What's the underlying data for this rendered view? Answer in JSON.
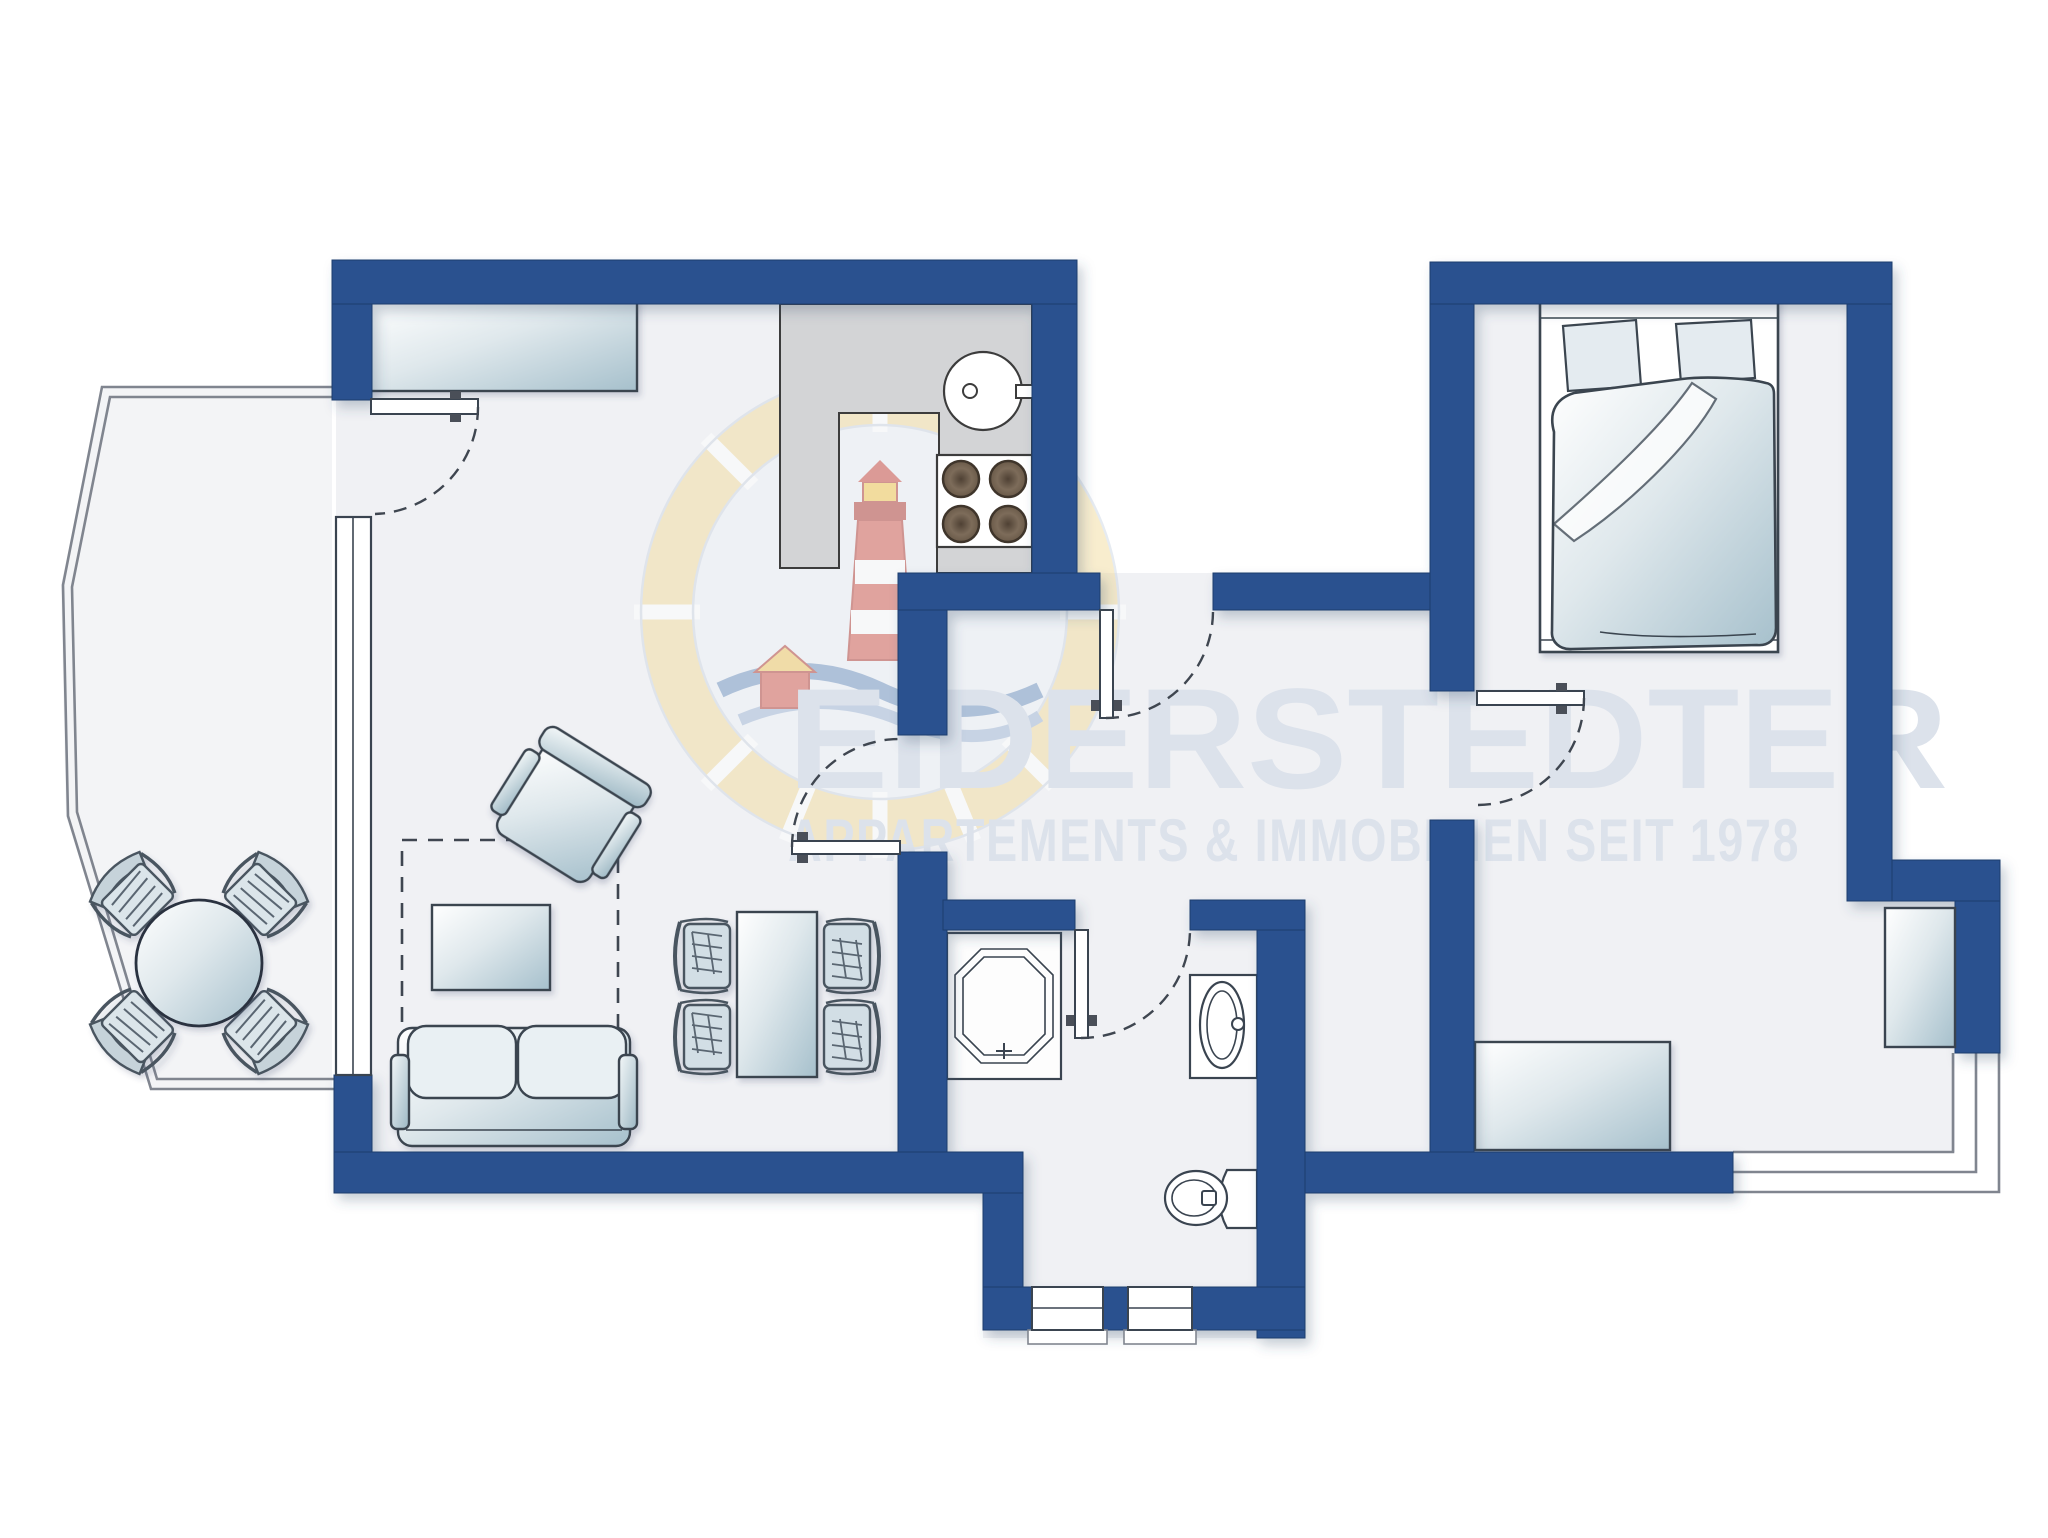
{
  "watermark": {
    "title": "EIDERSTEDTER",
    "subtitle": "APPARTEMENTS & IMMOBILIEN SEIT 1978",
    "logo": "lighthouse-badge-icon"
  },
  "colors": {
    "wall": "#2a518f",
    "floor": "#f0f1f4",
    "balcony": "#f3f4f6",
    "outline": "#3a4450",
    "counter": "#d3d4d6",
    "watermark": "#dce2eb",
    "railing": "#80858f",
    "dash": "#3f4650"
  },
  "plan": {
    "type": "apartment-floor-plan",
    "rooms": [
      {
        "name": "living-room-with-open-kitchen",
        "furniture": [
          "sideboard",
          "armchair",
          "rug",
          "coffee-table",
          "sofa",
          "dining-table",
          "dining-chairs",
          "kitchen-counter",
          "kitchen-sink",
          "stove-4-burners"
        ]
      },
      {
        "name": "hallway",
        "features": [
          "entry-door",
          "living-room-door"
        ]
      },
      {
        "name": "shower-room",
        "furniture": [
          "shower",
          "washbasin",
          "toilet"
        ],
        "features": [
          "two-small-windows"
        ]
      },
      {
        "name": "bedroom",
        "furniture": [
          "double-bed",
          "two-pillows",
          "duvet",
          "dresser"
        ],
        "features": [
          "bedroom-door",
          "niche-window"
        ]
      },
      {
        "name": "balcony-left",
        "furniture": [
          "round-table",
          "four-patio-chairs"
        ],
        "features": [
          "balcony-door",
          "tall-window"
        ]
      },
      {
        "name": "balcony-bottom-right",
        "features": [
          "railing"
        ]
      }
    ]
  }
}
